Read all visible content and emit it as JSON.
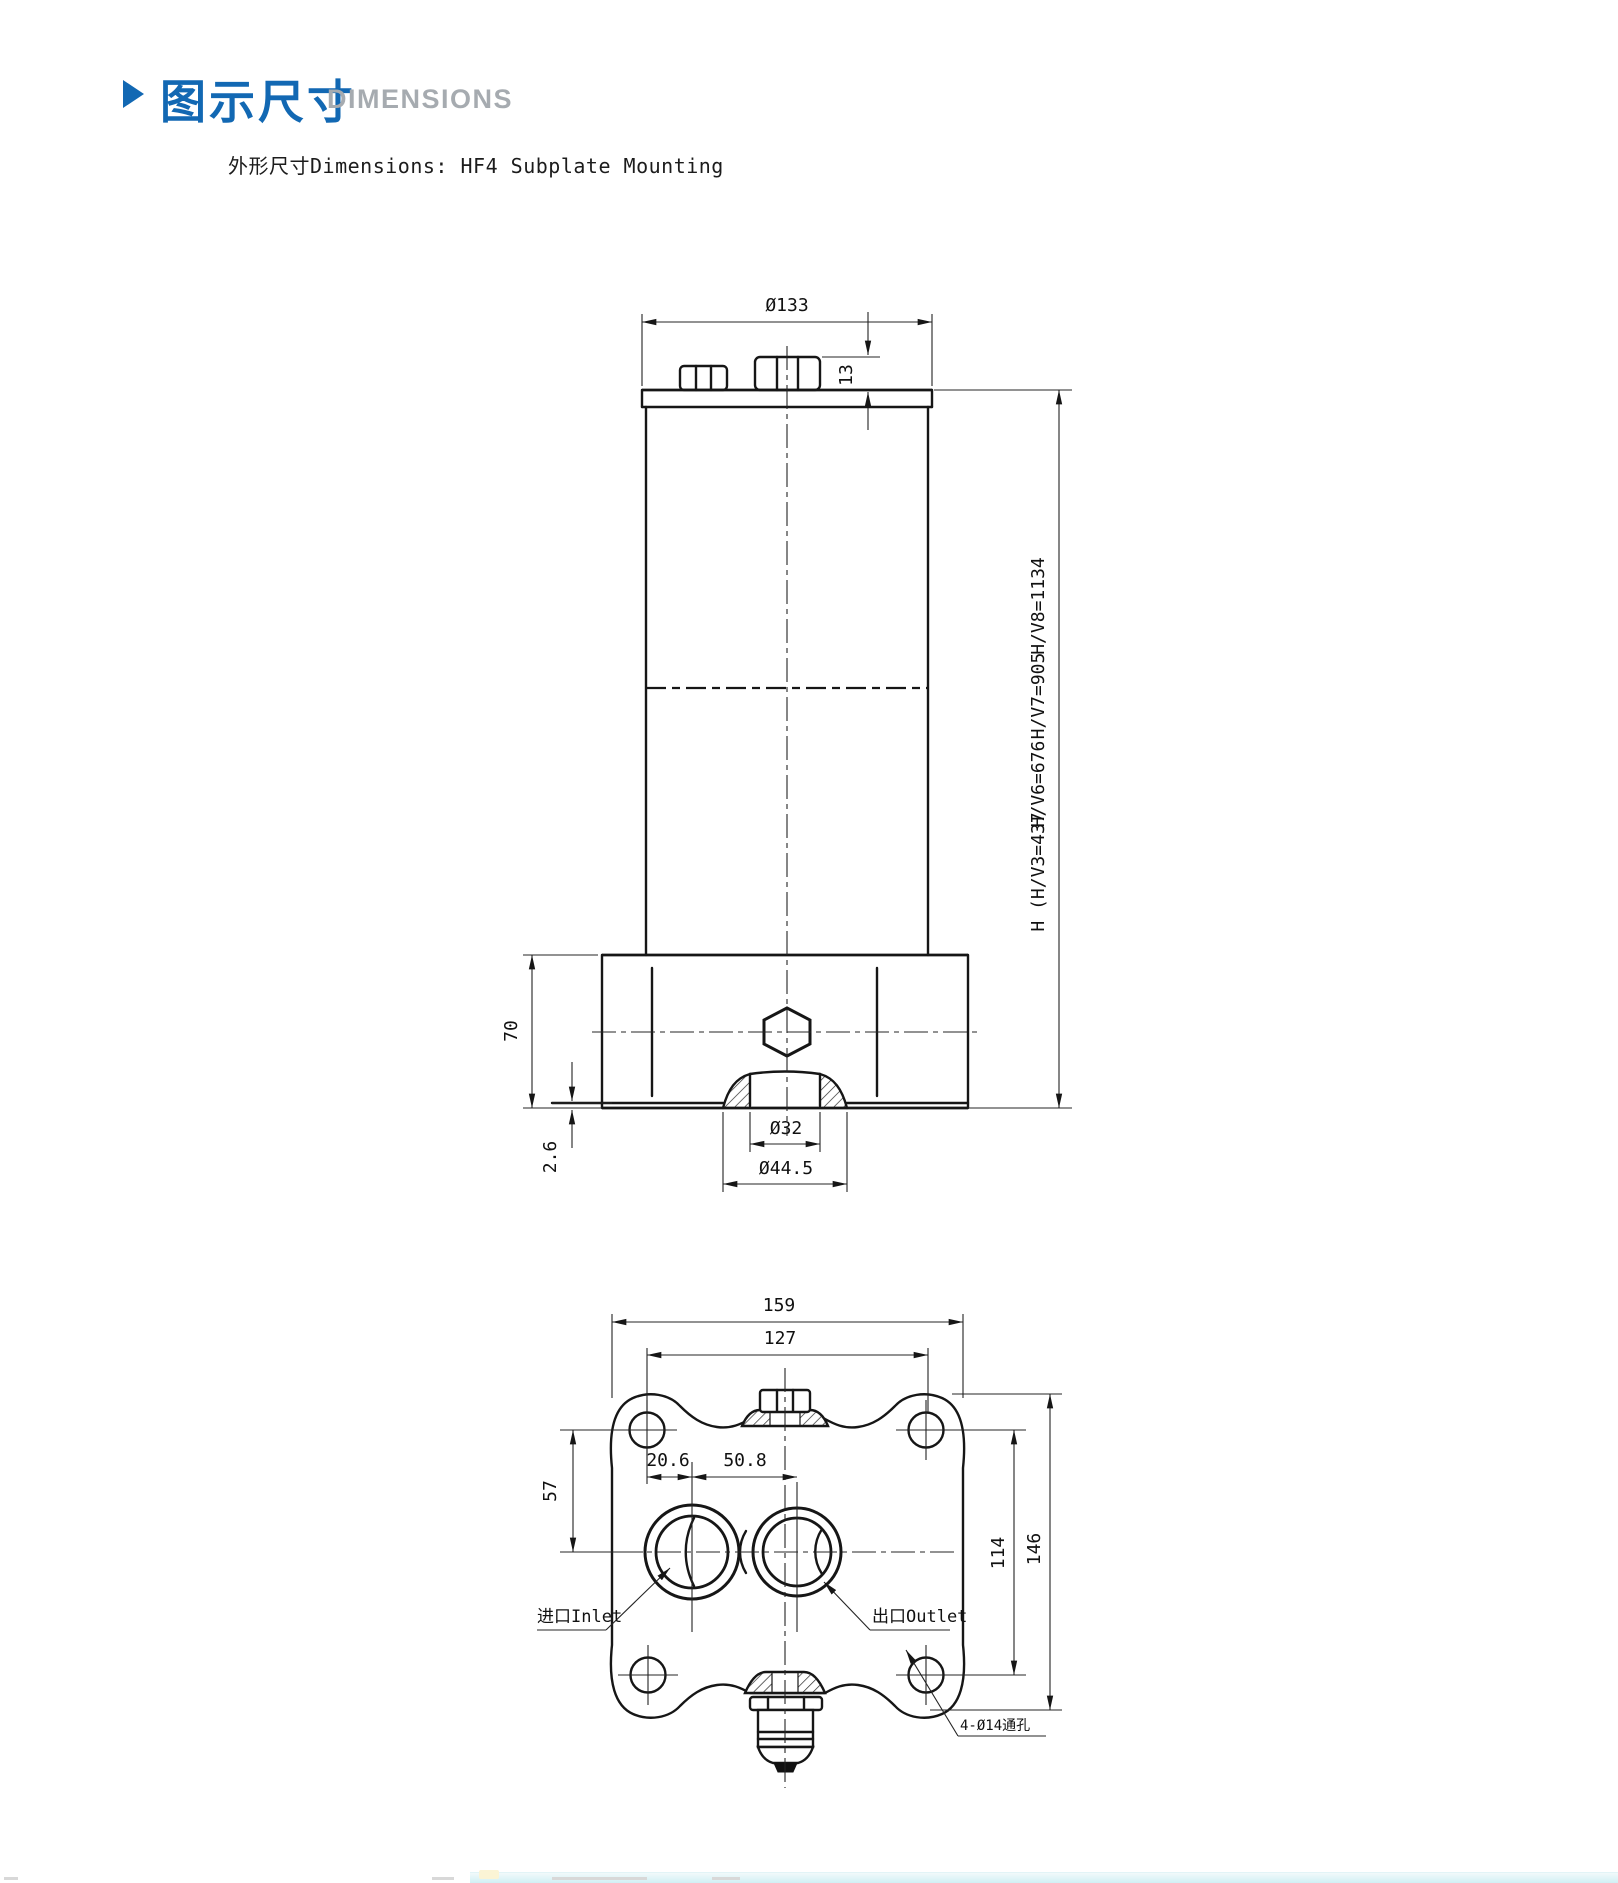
{
  "header": {
    "title_zh": "图示尺寸",
    "title_en": "DIMENSIONS",
    "subtitle": "外形尺寸Dimensions: HF4 Subplate Mounting"
  },
  "front_view": {
    "top_diameter": "Ø133",
    "cap_height": "13",
    "height_labels": [
      "H/V8=1134",
      "H/V7=905",
      "H/V6=676",
      "H (H/V3=437"
    ],
    "base_height": "70",
    "base_step": "2.6",
    "boss_inner_diameter": "Ø32",
    "boss_outer_diameter": "Ø44.5"
  },
  "bottom_view": {
    "overall_width": "159",
    "bolt_spacing_width": "127",
    "port_vertical_offset": "57",
    "inlet_offset": "20.6",
    "port_spacing": "50.8",
    "bolt_spacing_height": "114",
    "overall_height": "146",
    "inlet_label": "进口Inlet",
    "outlet_label": "出口Outlet",
    "holes_note": "4-Ø14通孔"
  },
  "colors": {
    "accent_blue": "#1268b3",
    "heading_gray": "#a6abb0",
    "line_black": "#161616",
    "footer_cyan": "#cdeef3"
  }
}
